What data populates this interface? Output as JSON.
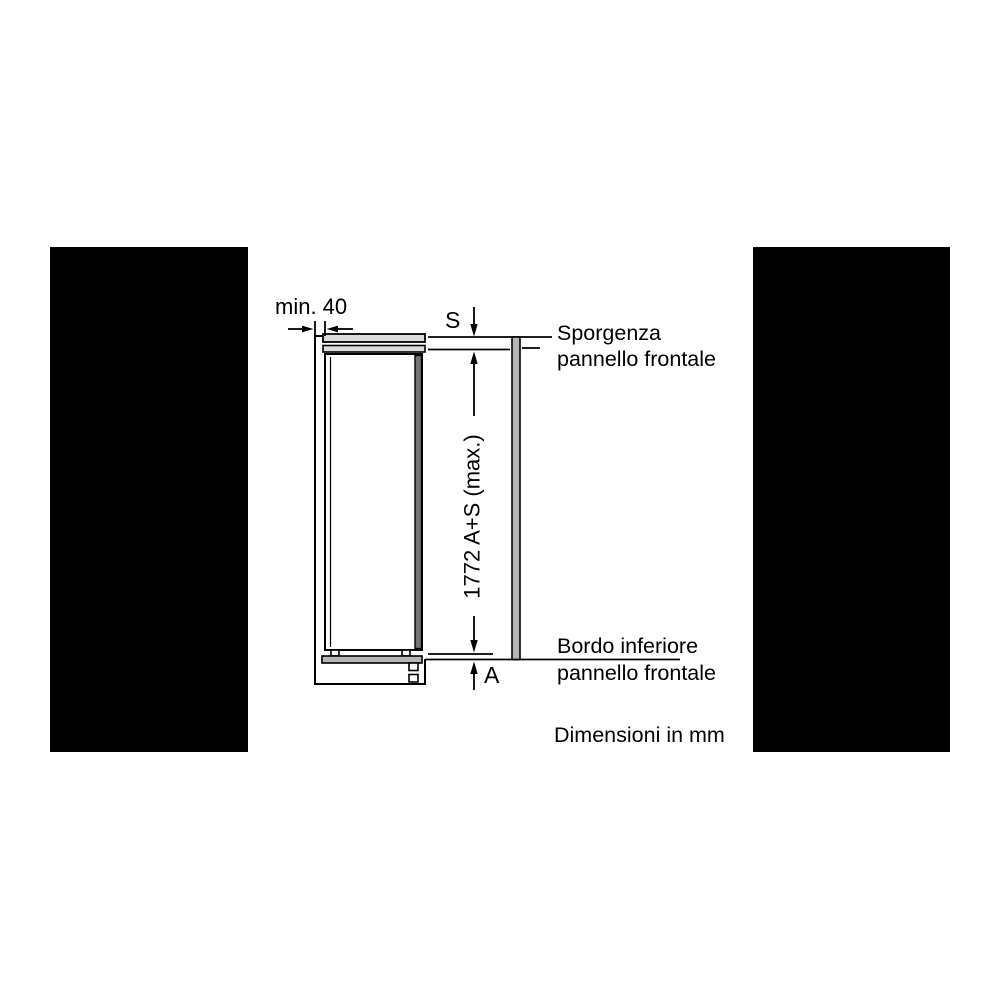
{
  "diagram": {
    "labels": {
      "min_clearance": "min. 40",
      "dim_s": "S",
      "sporgenza": [
        "Sporgenza",
        "pannello frontale"
      ],
      "height_dim": "1772 A+S (max.)",
      "bordo": [
        "Bordo inferiore",
        "pannello frontale"
      ],
      "dim_a": "A",
      "units_note": "Dimensioni in mm"
    },
    "colors": {
      "line": "#000000",
      "mask": "#000000",
      "panel_gray": "#b5b5b5",
      "bar_gray": "#dcdcdc",
      "door_edge_gray": "#757575",
      "background": "#ffffff"
    }
  }
}
